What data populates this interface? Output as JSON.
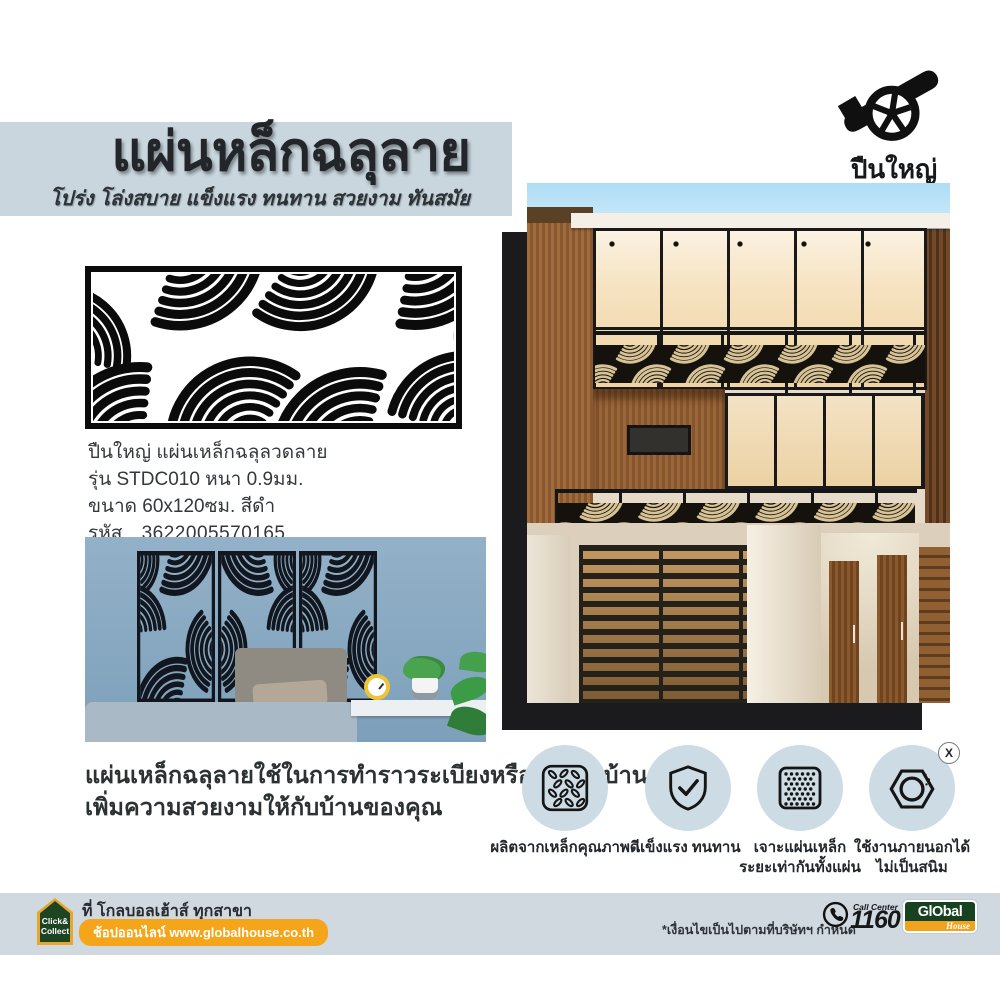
{
  "header": {
    "title": "แผ่นหล็กฉลุลาย",
    "subtitle": "โปร่ง โล่งสบาย แข็งแรง ทนทาน สวยงาม ทันสมัย"
  },
  "brand": {
    "name": "ปืนใหญ่",
    "icon": "cannon-icon"
  },
  "product": {
    "lines": [
      "ปืนใหญ่ แผ่นเหล็กฉลุลวดลาย",
      "รุ่น STDC010 หนา 0.9มม.",
      "ขนาด 60x120ซม. สีดำ"
    ],
    "code_label": "รหัส",
    "code_value": "3622005570165"
  },
  "description": {
    "lines": [
      "แผ่นเหล็กฉลุลายใช้ในการทำราวระเบียงหรือตกแต่งบ้าน",
      "เพิ่มความสวยงามให้กับบ้านของคุณ"
    ]
  },
  "features": [
    {
      "icon": "checker-plate-icon",
      "lines": [
        "ผลิตจากเหล็กคุณภาพดี",
        ""
      ]
    },
    {
      "icon": "shield-check-icon",
      "lines": [
        "แข็งแรง ทนทาน",
        ""
      ]
    },
    {
      "icon": "perforated-plate-icon",
      "lines": [
        "เจาะแผ่นเหล็ก",
        "ระยะเท่ากันทั้งแผ่น"
      ]
    },
    {
      "icon": "rustproof-nut-icon",
      "lines": [
        "ใช้งานภายนอกได้",
        "ไม่เป็นสนิม"
      ],
      "badge": "X"
    }
  ],
  "footer": {
    "click_collect": {
      "line1": "Click&",
      "line2": "Collect"
    },
    "branch_text": "ที่ โกลบอลเฮ้าส์ ทุกสาขา",
    "online_text": "ช้อปออนไลน์ www.globalhouse.co.th",
    "disclaimer": "*เงื่อนไขเป็นไปตามที่บริษัทฯ กำหนด",
    "call_center_label": "Call Center",
    "call_center_number": "1160",
    "global_logo": {
      "top": "GlObal",
      "bottom": "House"
    }
  },
  "colors": {
    "band_blue": "#c9d6de",
    "footer_blue": "#cfd9df",
    "feature_circle_blue": "#ccdbe4",
    "accent_yellow": "#f5a519",
    "brand_green": "#1d4423",
    "room_wall_blue": "#8fafc7",
    "pattern_black": "#141414"
  }
}
